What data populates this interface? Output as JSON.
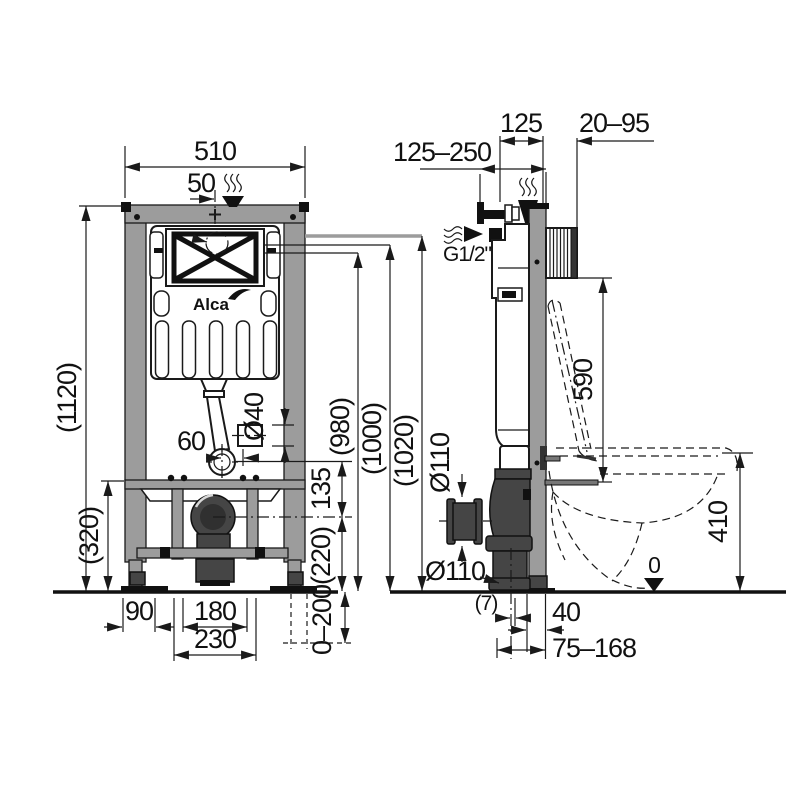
{
  "brand": {
    "logo": "Alca"
  },
  "front_view": {
    "overall_width": "510",
    "inlet_offset": "50",
    "overall_height": "(1120)",
    "lower_frame_height": "(320)",
    "flush_bend_offset": "60",
    "flush_pipe_diameter": "Ø40",
    "bend_to_outlet": "135",
    "outlet_height": "(220)",
    "level_980": "(980)",
    "level_1000": "(1000)",
    "level_1020": "(1020)",
    "foot_offset": "90",
    "outlet_width": "180",
    "outlet_frame_width": "230",
    "leg_adjustment": "0–200"
  },
  "side_view": {
    "inlet_height_range": "125–250",
    "frame_depth": "125",
    "wall_thickness_range": "20–95",
    "water_connection": "G1/2\"",
    "cistern_top_height": "590",
    "outlet_diameter_upper": "Ø110",
    "outlet_diameter_lower": "Ø110",
    "bowl_height": "410",
    "floor_datum": "0",
    "pipe_offset": "(7)",
    "outlet_wall_distance": "40",
    "outlet_range": "75–168"
  }
}
